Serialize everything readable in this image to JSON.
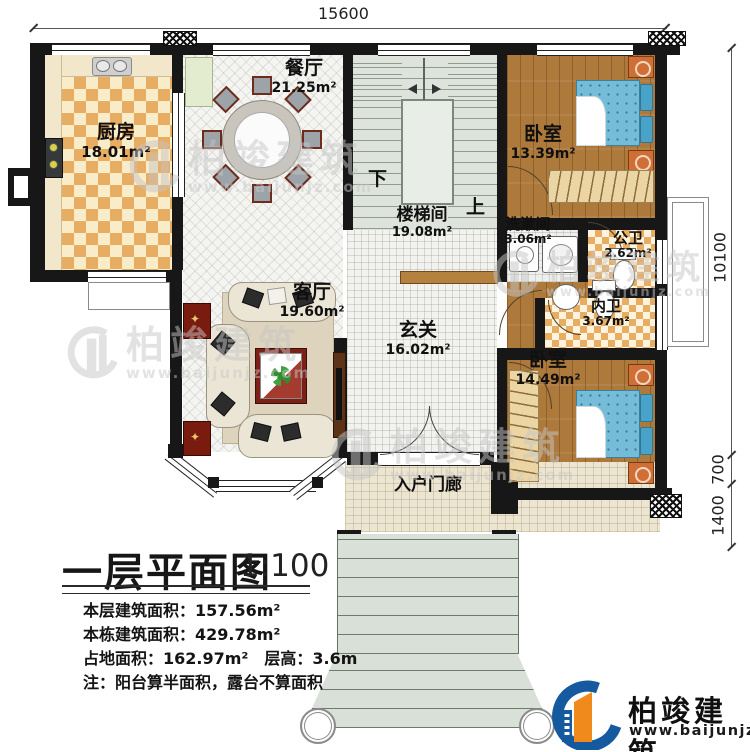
{
  "drawing": {
    "title": "一层平面图",
    "scale": "1:100",
    "stats": [
      "本层建筑面积：157.56m²",
      "本栋建筑面积：429.78m²",
      "占地面积：162.97m²　层高：3.6m",
      "注：阳台算半面积，露台不算面积"
    ]
  },
  "dimensions": {
    "top": "15600",
    "right_main": "10100",
    "right_mid": "700",
    "right_bottom": "1400"
  },
  "rooms": {
    "kitchen": {
      "name": "厨房",
      "area": "18.01m²"
    },
    "dining": {
      "name": "餐厅",
      "area": "21.25m²"
    },
    "bedroom1": {
      "name": "卧室",
      "area": "13.39m²"
    },
    "stairhall": {
      "name": "楼梯间",
      "area": "19.08m²"
    },
    "washroom": {
      "name": "洗漱间",
      "area": "3.06m²"
    },
    "public_bath": {
      "name": "公卫",
      "area": "2.62m²"
    },
    "inner_bath": {
      "name": "内卫",
      "area": "3.67m²"
    },
    "living": {
      "name": "客厅",
      "area": "19.60m²"
    },
    "foyer": {
      "name": "玄关",
      "area": "16.02m²"
    },
    "bedroom2": {
      "name": "卧室",
      "area": "14.49m²"
    },
    "porch": {
      "name": "入户门廊"
    }
  },
  "stairs": {
    "down": "下",
    "up": "上"
  },
  "brand": {
    "name": "柏竣建筑",
    "url": "www.baijunjz.com"
  },
  "colors": {
    "wall": "#171717",
    "wood": "#ad7a3c",
    "kitchen_checker": "#e7ad62",
    "bed": "#74bcd8",
    "logo_blue": "#15599f",
    "logo_orange": "#f08a1d",
    "stair_floor": "#dee4dc"
  }
}
